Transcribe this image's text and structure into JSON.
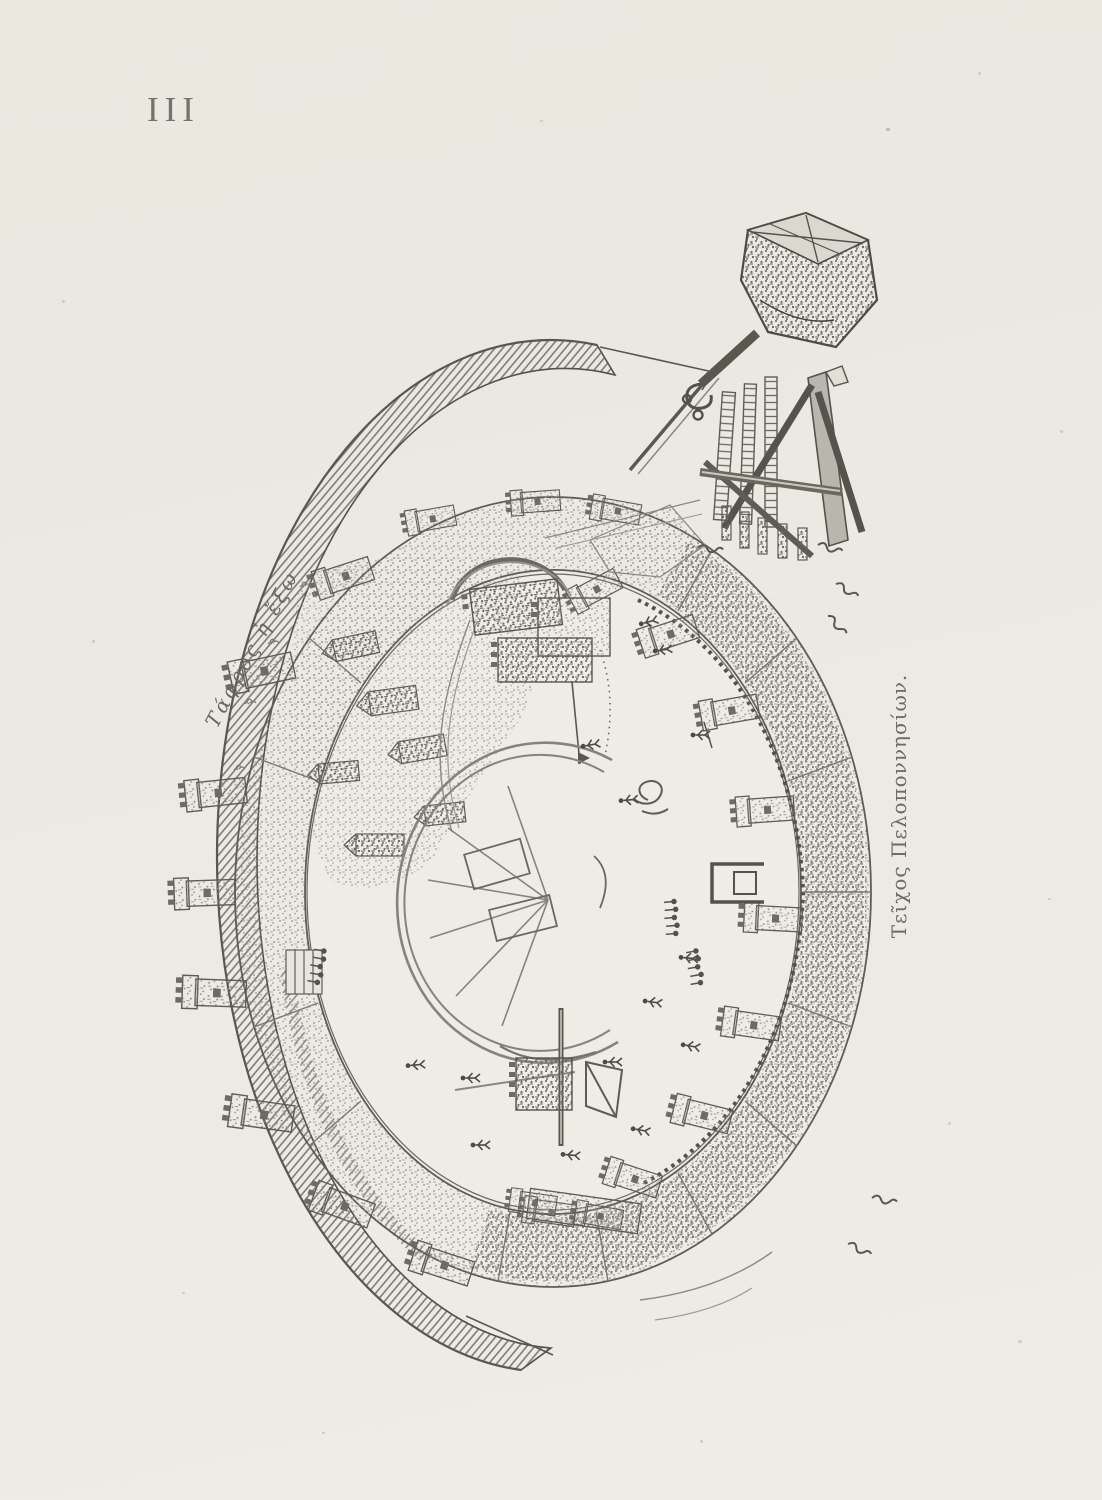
{
  "page": {
    "plate_number": "III"
  },
  "figure": {
    "moat_inscription": "Τάφρος ἡ ἔξω",
    "caption": "Τεῖχος Πελοποννησίων."
  },
  "colors": {
    "paper": "#ebe9e2",
    "ink": "#57544d",
    "ink_light": "#8e8b82",
    "ink_faint": "#b5b2a9"
  }
}
